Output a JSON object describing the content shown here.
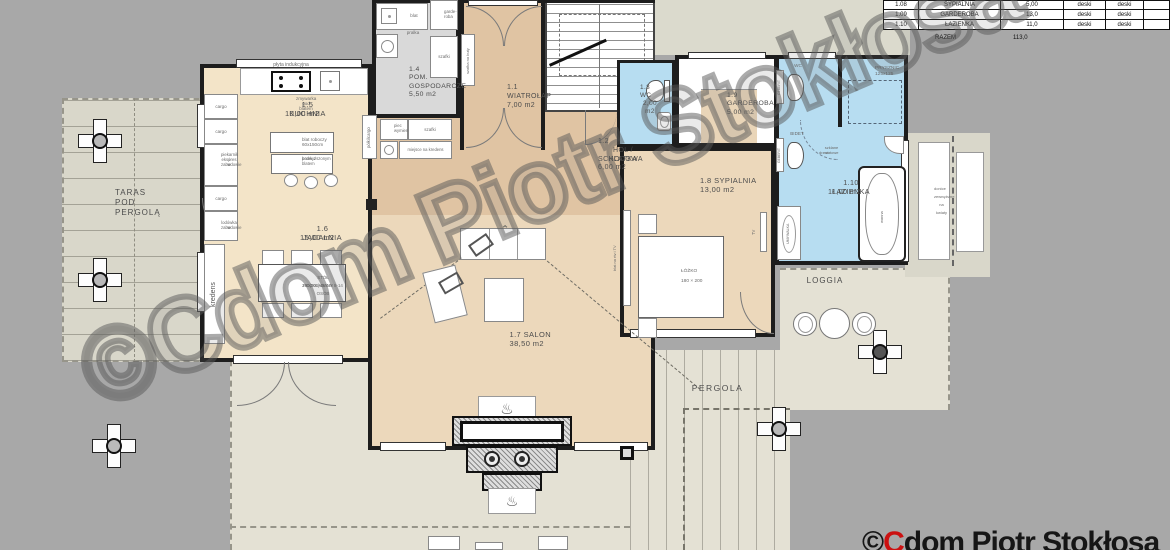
{
  "legend_table": {
    "rows": [
      {
        "no": "1.08",
        "name": "SYPIALNIA",
        "area": "5,00",
        "fin1": "deski",
        "fin2": "deski"
      },
      {
        "no": "1.09",
        "name": "GARDEROBA",
        "area": "13,0",
        "fin1": "deski",
        "fin2": "deski"
      },
      {
        "no": "1.10",
        "name": "ŁAZIENKA",
        "area": "11,0",
        "fin1": "deski",
        "fin2": "deski"
      }
    ],
    "total_label": "RAZEM",
    "total_value": "113,0"
  },
  "watermark_text": "©Cdom Piotr Stokłosa",
  "brand": {
    "copy": "©",
    "initial": "C",
    "rest": "dom Piotr Stokłosa"
  },
  "rooms": {
    "wiatrolap": {
      "l1": "1.1",
      "l2": "WIATROŁAP",
      "l3": "7,00 m2"
    },
    "hol": {
      "l1": "1.2",
      "l2": "HOL / KLATKA",
      "l3": "SCHODOWA",
      "l4": "6,00 m2"
    },
    "wc": {
      "l1": "1.3",
      "l2": "WC",
      "l3": "2,00 m2"
    },
    "gospodarcze": {
      "l1": "1.4",
      "l2": "POM.",
      "l3": "GOSPODARCZE",
      "l4": "5,50 m2"
    },
    "kuchnia": {
      "l1": "1.5 KUCHNIA",
      "l2": "10,00 m2"
    },
    "jadalnia": {
      "l1": "1.6 JADALNIA",
      "l2": "15,00 m2"
    },
    "salon": {
      "l1": "1.7 SALON",
      "l2": "38,50 m2"
    },
    "sypialnia": {
      "l1": "1.8 SYPIALNIA",
      "l2": "13,00 m2"
    },
    "garderoba": {
      "l1": "1.9",
      "l2": "GARDEROBA",
      "l3": "5,00 m2"
    },
    "lazienka": {
      "l1": "1.10 ŁAZIENKA",
      "l2": "11,00 m2"
    },
    "taras": {
      "l1": "TARAS",
      "l2": "POD",
      "l3": "PERGOLĄ"
    },
    "loggia": "LOGGIA",
    "pergola": "PERGOLA"
  },
  "labels": {
    "plyta": "płyta indukcyjna",
    "zmywarka_l1": "zmywarka",
    "zmywarka_l2": "pod blatem",
    "cargo": "cargo",
    "piekarnik_l1": "piekarnik i",
    "piekarnik_l2": "ekspres w",
    "piekarnik_l3": "zabudowie",
    "lodowka_l1": "lodówka w",
    "lodowka_l2": "zabudowie",
    "polki_cargo": "półki/cargo",
    "blat_roboczy_l1": "blat roboczy",
    "blat_roboczy_l2": "60x150cm",
    "barek_l1": "barek z",
    "barek_l2": "podwyższonym",
    "barek_l3": "blatem",
    "kredens": "kredens",
    "stol_l1": "STÓŁ ROZKŁADANY 8-14 OSÓB",
    "stol_l2": "240(300)x90cm",
    "blat": "blat",
    "garde_l1": "garde-",
    "garde_l2": "roba",
    "pralka": "pralka",
    "szafki": "szafki",
    "szafka_buty": "szafka na buty",
    "piec_l1": "piec",
    "piec_l2": "wymiennik",
    "miejsce_kredens": "miejsce na kredens",
    "lozko_l1": "ŁÓŻKO",
    "lozko_l2": "180 × 200",
    "blat_rtv": "blat na rtv i TV",
    "tv": "TV",
    "wc": "WC",
    "bidet": "BIDET",
    "geberit": "GEBERIT",
    "prysznic_l1": "PRYSZNIC",
    "prysznic_l2": "125x125",
    "szklane_l1": "szklane matowe",
    "szklane_l2": "drzwi",
    "wanna": "wanna",
    "umywalka": "UMYWALKA",
    "donice_l1": "donice",
    "donice_l2": "zewnętrzne",
    "donice_l3": "na kwiaty"
  },
  "colors": {
    "exterior": "#a8a8a8",
    "terrace": "#e4e1d4",
    "terrace_dark": "#d9d7ca",
    "terrace_top": "#dbdacd",
    "kitchen": "#f3e4c8",
    "interior_warm": "#ecd8bb",
    "interior_hot": "#e0c4a3",
    "wet": "#b7ddf1",
    "utility": "#d9d9d9",
    "wardrobe": "#e9d5b8",
    "wall": "#1d1d1d",
    "brand_red": "#cc1111"
  }
}
